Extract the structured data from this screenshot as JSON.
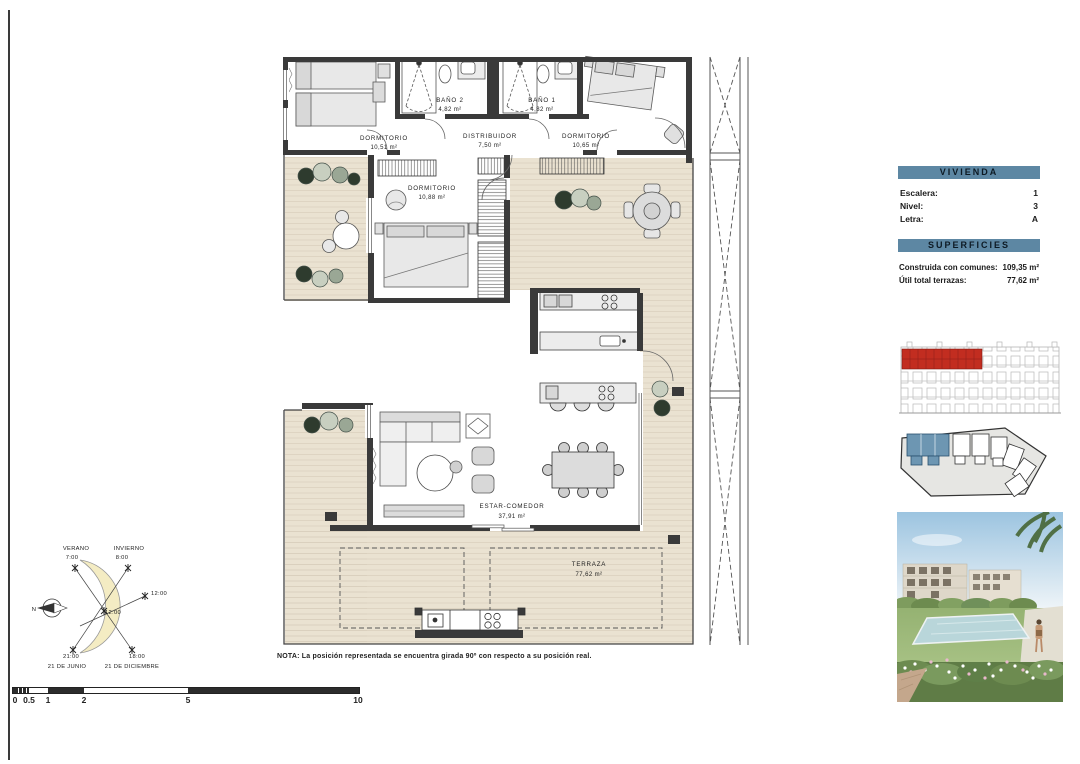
{
  "document": {
    "note": "NOTA: La posición representada se encuentra girada 90º con respecto a su posición real."
  },
  "panel": {
    "vivienda_title": "VIVIENDA",
    "info_rows": [
      {
        "label": "Escalera:",
        "value": "1"
      },
      {
        "label": "Nivel:",
        "value": "3"
      },
      {
        "label": "Letra:",
        "value": "A"
      }
    ],
    "superficies_title": "SUPERFICIES",
    "area_rows": [
      {
        "label": "Construida con comunes:",
        "value": "109,35 m²"
      },
      {
        "label": "Útil total terrazas:",
        "value": "77,62 m²"
      }
    ]
  },
  "plan": {
    "rooms": [
      {
        "name": "DORMITORIO",
        "area": "10,51 m²"
      },
      {
        "name": "BAÑO 2",
        "area": "4,82 m²"
      },
      {
        "name": "DISTRIBUIDOR",
        "area": "7,50 m²"
      },
      {
        "name": "BAÑO 1",
        "area": "4,82 m²"
      },
      {
        "name": "DORMITORIO",
        "area": "10,65 m²"
      },
      {
        "name": "DORMITORIO",
        "area": "10,88 m²"
      },
      {
        "name": "ESTAR-COMEDOR",
        "area": "37,91 m²"
      },
      {
        "name": "TERRAZA",
        "area": "77,62 m²"
      }
    ]
  },
  "sun_diagram": {
    "verano_label": "VERANO",
    "verano_time": "7:00",
    "invierno_label": "INVIERNO",
    "invierno_time": "8:00",
    "time_right": "12:00",
    "time_center": "12:00",
    "summer_time": "21:00",
    "summer_date": "21 DE JUNIO",
    "winter_time": "18:00",
    "winter_date": "21 DE DICIEMBRE",
    "north": "N"
  },
  "scale_bar": {
    "ticks": [
      "0",
      "0.5",
      "1",
      "2",
      "5",
      "10"
    ]
  },
  "colors": {
    "panel_header_blue": "#5d87a3",
    "elevation_highlight_red": "#c22d20",
    "siteplan_highlight_blue": "#6d96b2",
    "floor_beige": "#eae2d1",
    "wall_dark": "#3a3a3a"
  }
}
